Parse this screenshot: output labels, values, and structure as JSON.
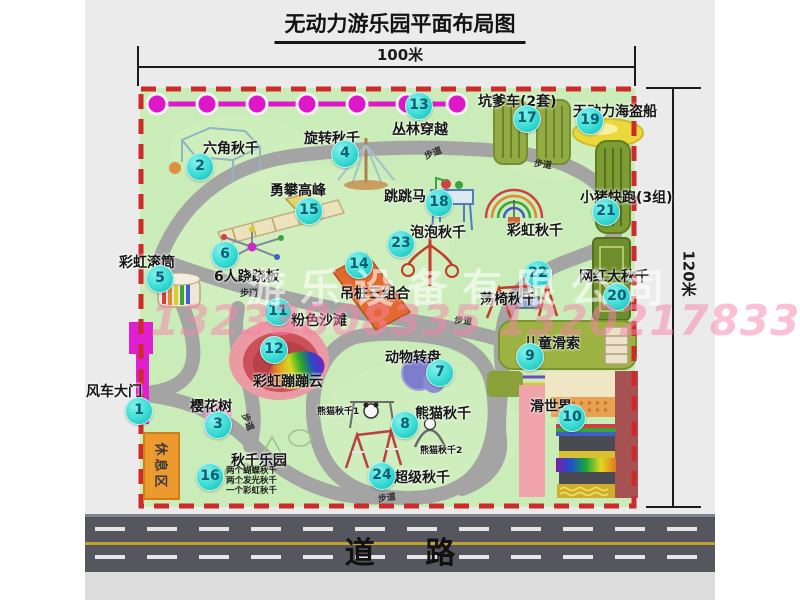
{
  "page": {
    "title": "无动力游乐园平面布局图",
    "top_dimension": "100米",
    "right_dimension": "120米",
    "road_label": "道  路",
    "watermark_company": "游乐设备有限公司",
    "watermark_phone": "13233808335 13202178333"
  },
  "map": {
    "rest_area": "休息区",
    "attractions": [
      {
        "num": 1,
        "name": "风车大门",
        "bx": 138,
        "by": 410,
        "lx": 86,
        "ly": 381
      },
      {
        "num": 2,
        "name": "六角秋千",
        "bx": 199,
        "by": 166,
        "lx": 203,
        "ly": 138
      },
      {
        "num": 3,
        "name": "樱花树",
        "bx": 217,
        "by": 424,
        "lx": 190,
        "ly": 396
      },
      {
        "num": 4,
        "name": "旋转秋千",
        "bx": 344,
        "by": 153,
        "lx": 304,
        "ly": 128
      },
      {
        "num": 5,
        "name": "彩虹滚筒",
        "bx": 159,
        "by": 278,
        "lx": 119,
        "ly": 252
      },
      {
        "num": 6,
        "name": "6人跷跷板",
        "bx": 224,
        "by": 254,
        "lx": 214,
        "ly": 266
      },
      {
        "num": 7,
        "name": "动物转盘",
        "bx": 439,
        "by": 372,
        "lx": 385,
        "ly": 347
      },
      {
        "num": 8,
        "name": "熊猫秋千",
        "bx": 404,
        "by": 424,
        "lx": 415,
        "ly": 403
      },
      {
        "num": 9,
        "name": "儿童滑索",
        "bx": 529,
        "by": 356,
        "lx": 524,
        "ly": 333
      },
      {
        "num": 10,
        "name": "滑世界",
        "bx": 571,
        "by": 417,
        "lx": 530,
        "ly": 396
      },
      {
        "num": 11,
        "name": "粉色沙滩",
        "bx": 277,
        "by": 311,
        "lx": 291,
        "ly": 310
      },
      {
        "num": 12,
        "name": "彩虹蹦蹦云",
        "bx": 273,
        "by": 349,
        "lx": 253,
        "ly": 371
      },
      {
        "num": 13,
        "name": "丛林穿越",
        "bx": 418,
        "by": 105,
        "lx": 392,
        "ly": 119
      },
      {
        "num": 14,
        "name": "吊桩三组合",
        "bx": 358,
        "by": 264,
        "lx": 340,
        "ly": 283
      },
      {
        "num": 15,
        "name": "勇攀高峰",
        "bx": 308,
        "by": 210,
        "lx": 270,
        "ly": 180
      },
      {
        "num": 16,
        "name": "秋千乐园",
        "bx": 209,
        "by": 476,
        "lx": 231,
        "ly": 450
      },
      {
        "num": 17,
        "name": "坑爹车(2套)",
        "bx": 526,
        "by": 118,
        "lx": 478,
        "ly": 91
      },
      {
        "num": 18,
        "name": "跳跳马",
        "bx": 438,
        "by": 202,
        "lx": 384,
        "ly": 186
      },
      {
        "num": 19,
        "name": "无动力海盗船",
        "bx": 589,
        "by": 120,
        "lx": 573,
        "ly": 101
      },
      {
        "num": 20,
        "name": "网红大秋千",
        "bx": 616,
        "by": 296,
        "lx": 579,
        "ly": 266
      },
      {
        "num": 21,
        "name": "小猪快跑(3组)",
        "bx": 605,
        "by": 211,
        "lx": 580,
        "ly": 187
      },
      {
        "num": 22,
        "name": "荡椅秋千",
        "bx": 537,
        "by": 273,
        "lx": 480,
        "ly": 289
      },
      {
        "num": 23,
        "name": "泡泡秋千",
        "bx": 400,
        "by": 243,
        "lx": 410,
        "ly": 222
      },
      {
        "num": 24,
        "name": "超级秋千",
        "bx": 381,
        "by": 475,
        "lx": 394,
        "ly": 467
      }
    ],
    "unnumbered_labels": [
      {
        "text": "彩虹秋千",
        "x": 507,
        "y": 220,
        "size": 14
      },
      {
        "text": "熊猫秋千1",
        "x": 317,
        "y": 404,
        "size": 9
      },
      {
        "text": "熊猫秋千2",
        "x": 420,
        "y": 443,
        "size": 9
      }
    ],
    "swing_park_notes": [
      "两个蝴蝶秋千",
      "两个发光秋千",
      "一个彩虹秋千"
    ],
    "path_labels": [
      {
        "text": "步道",
        "x": 240,
        "y": 286,
        "rot": 0
      },
      {
        "text": "步道",
        "x": 422,
        "y": 150,
        "rot": -22
      },
      {
        "text": "步道",
        "x": 535,
        "y": 156,
        "rot": 8
      },
      {
        "text": "步道",
        "x": 455,
        "y": 313,
        "rot": 5
      },
      {
        "text": "步道",
        "x": 251,
        "y": 411,
        "rot": 68
      },
      {
        "text": "步道",
        "x": 377,
        "y": 492,
        "rot": -8
      }
    ],
    "colors": {
      "badge": "#38dcd4",
      "border": "#cd2a2a",
      "grass": "#c9ecb8",
      "walkway": "#a4a4a4",
      "zipline": "#de17c9"
    }
  }
}
